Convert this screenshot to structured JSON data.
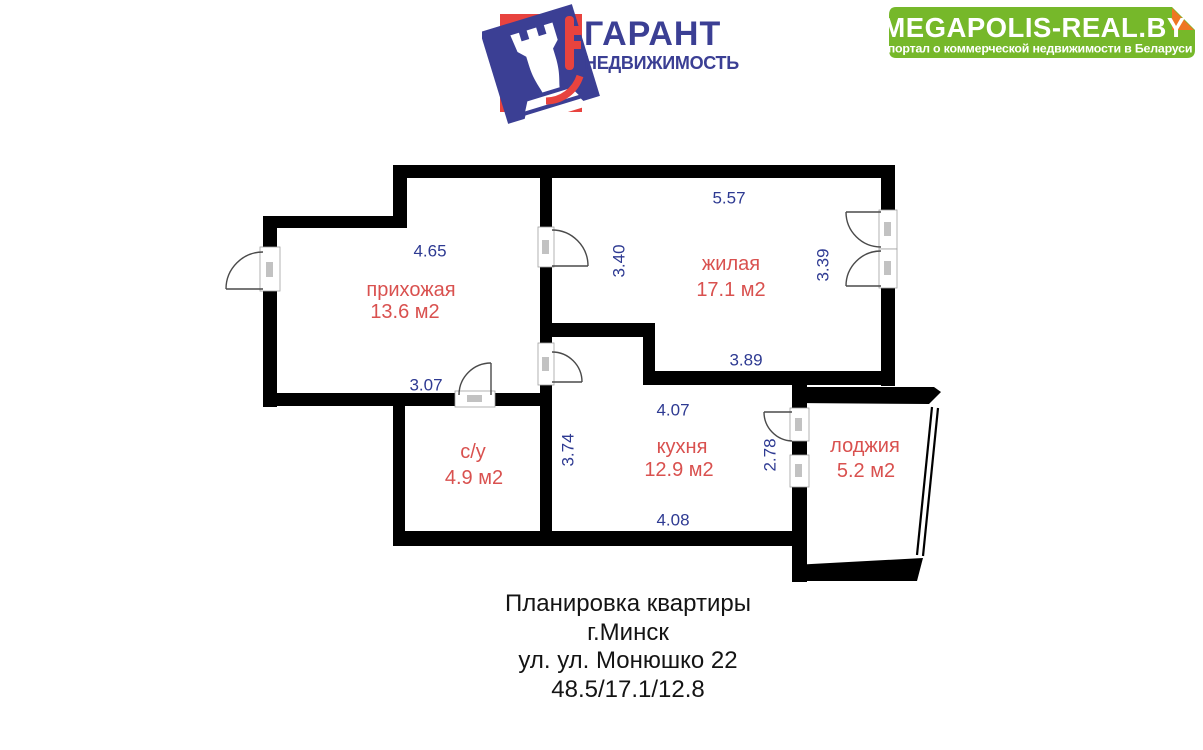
{
  "logo": {
    "brand": "ГАРАНТ",
    "subbrand": "НЕДВИЖИМОСТЬ",
    "brand_color": "#3b3f94",
    "accent_color": "#e8433e"
  },
  "banner": {
    "title": "MEGAPOLIS-REAL.BY",
    "subtitle": "портал о коммерческой недвижимости в Беларуси",
    "bg_color": "#76b82a",
    "fold_color": "#ee7623",
    "text_color": "#ffffff"
  },
  "floorplan": {
    "wall_color": "#000000",
    "room_label_color": "#d9514f",
    "dimension_color": "#2e3a92",
    "rooms": {
      "hallway": {
        "name": "прихожая",
        "area": "13.6 м2"
      },
      "living": {
        "name": "жилая",
        "area": "17.1 м2"
      },
      "kitchen": {
        "name": "кухня",
        "area": "12.9 м2"
      },
      "bathroom": {
        "name": "с/у",
        "area": "4.9 м2"
      },
      "loggia": {
        "name": "лоджия",
        "area": "5.2 м2"
      }
    },
    "dimensions": {
      "hallway_top": "4.65",
      "hallway_bottom": "3.07",
      "living_top": "5.57",
      "living_left": "3.40",
      "living_right": "3.39",
      "living_bottom": "3.89",
      "kitchen_top": "4.07",
      "kitchen_bottom": "4.08",
      "kitchen_left": "3.74",
      "kitchen_right": "2.78"
    }
  },
  "caption": {
    "line1": "Планировка квартиры",
    "line2": "г.Минск",
    "line3": "ул. ул. Монюшко 22",
    "line4": "48.5/17.1/12.8"
  }
}
